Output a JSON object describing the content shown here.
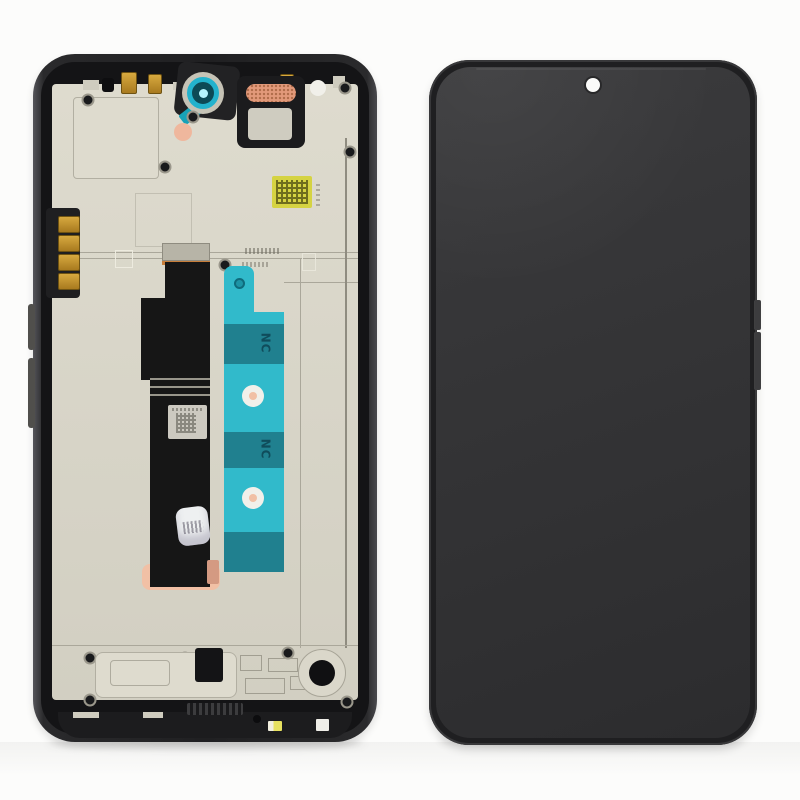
{
  "scene": {
    "background": "#fcfcfb",
    "subject": "smartphone-lcd-screen-assembly-with-frame",
    "views": [
      "back-frame-with-flex-and-adhesive",
      "front-black-display"
    ]
  },
  "colors": {
    "background": "#fcfcfb",
    "frame_dark": "#232325",
    "frame_edge": "#4a4a4e",
    "interior": "#141416",
    "plate": "#d2cfc2",
    "plate_light": "#dedbce",
    "plate_line": "#aaa79a",
    "screen_a": "#3b3b3d",
    "screen_b": "#2c2c2e",
    "teal_bright": "#31bacb",
    "teal_dark": "#20808f",
    "teal_text": "#0d4452",
    "camera_ring": "#23b2cd",
    "camera_core": "#0d4956",
    "camera_glint": "#b6f3fd",
    "copper_mesh": "#e2997a",
    "peach": "#f1c0a5",
    "gold": "#bf8c2d",
    "flex_black": "#161616",
    "sticker_yellow": "#d5d342",
    "sticker_gray": "#ccc9c0",
    "sticker_white": "#eef0f1",
    "hole_black": "#101012",
    "white_part": "#f1f0ea"
  },
  "labels": {
    "adhesive_marking_top": "NC",
    "adhesive_marking_bottom": "NC"
  }
}
